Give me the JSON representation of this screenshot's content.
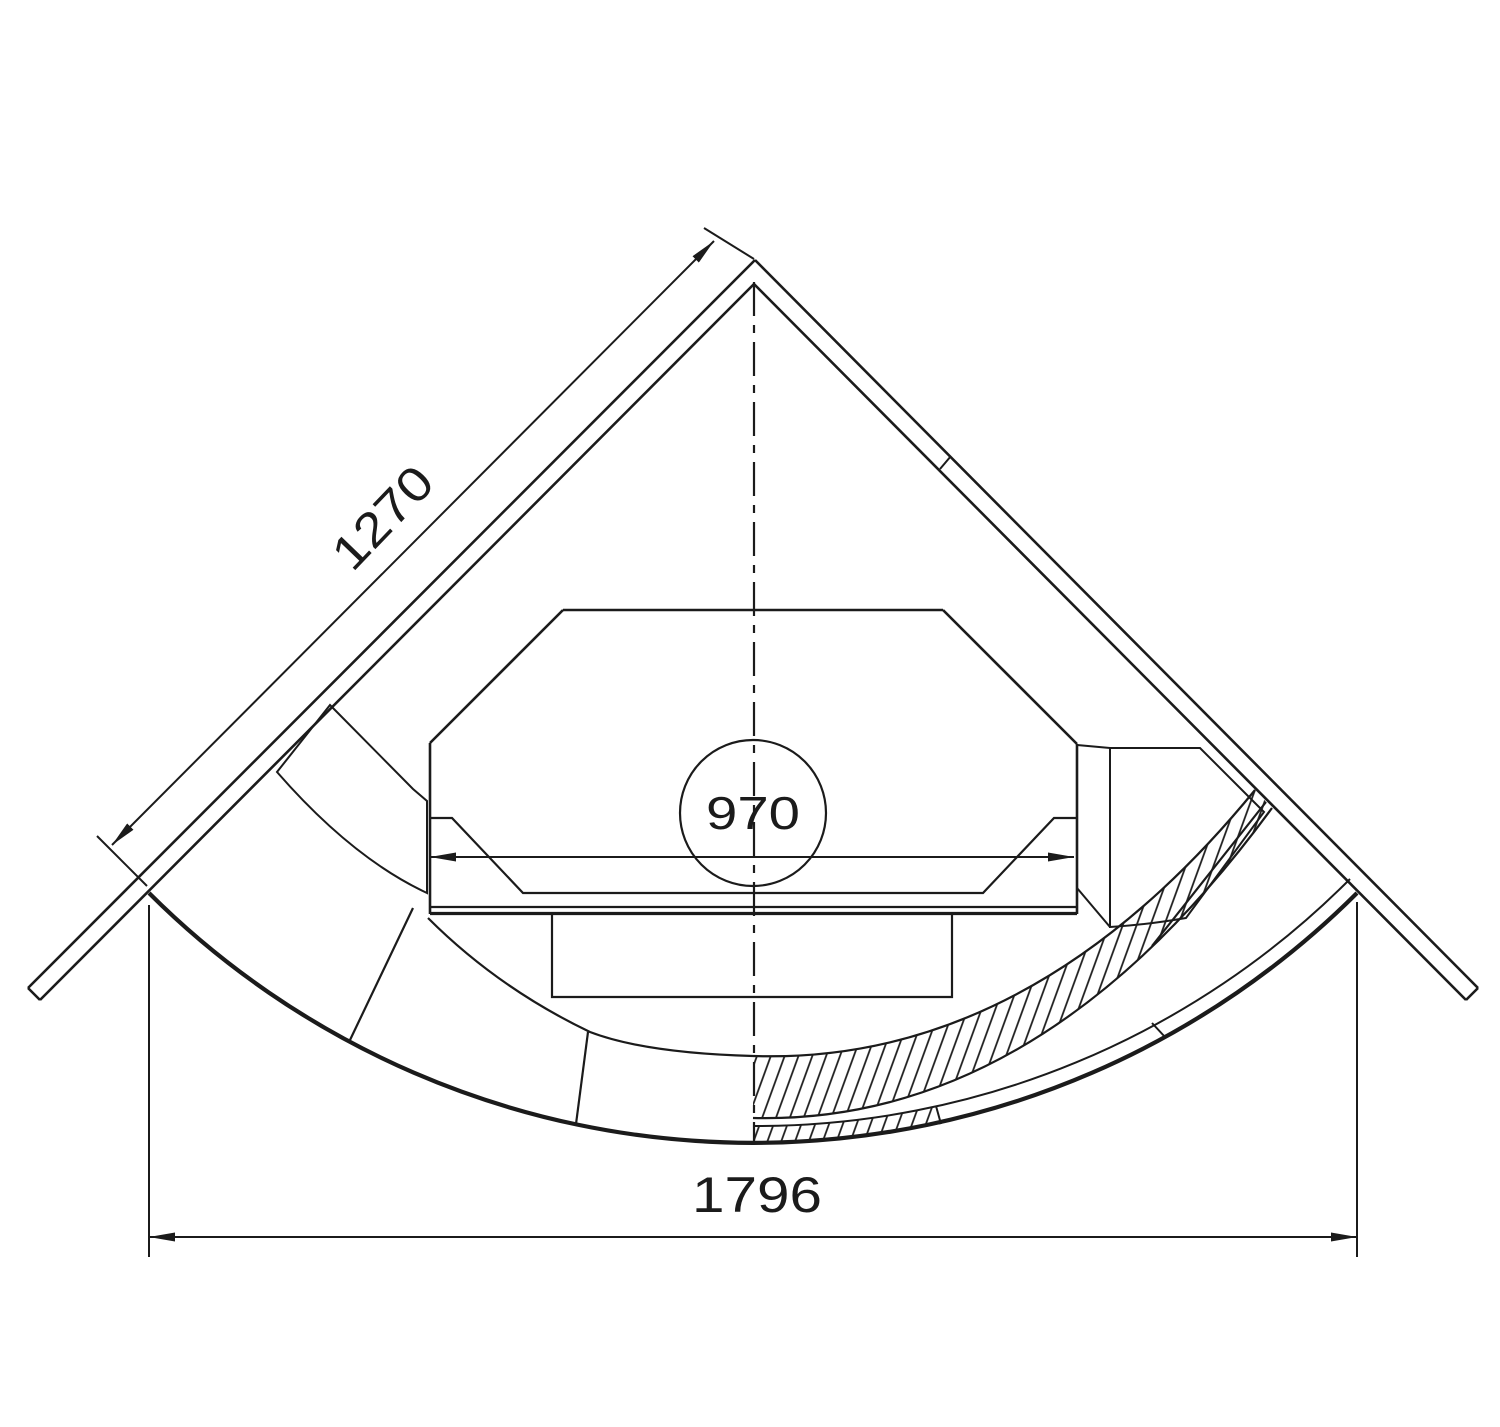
{
  "drawing": {
    "background": "#ffffff",
    "line_color": "#1b1b1b",
    "dimension_labels": {
      "side_wall": "1270",
      "firebox_opening": "970",
      "front_span": "1796"
    }
  }
}
